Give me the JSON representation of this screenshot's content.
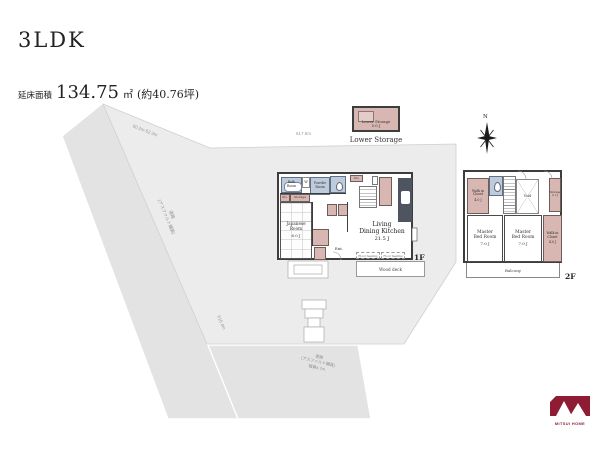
{
  "header": {
    "title": "3LDK",
    "area_label": "延床面積",
    "area_value": "134.75",
    "area_unit": "㎡",
    "area_tsubo": "(約40.76坪)"
  },
  "site": {
    "dim_top_left": "60.2m 62.3m",
    "dim_top": "617.5m",
    "dim_bottom_left": "616.4m",
    "road_left_line1": "道路",
    "road_left_line2": "(アスファルト舗装)",
    "road_bottom_line1": "道路",
    "road_bottom_line2": "(アスファルト舗装)",
    "road_bottom_line3": "幅員4.7m"
  },
  "lower_storage": {
    "label_line1": "Lower Storage",
    "label_line2": "5.0 J",
    "caption": "Lower Storage"
  },
  "compass": {
    "north_label": "N"
  },
  "floor1": {
    "floor_label": "1F",
    "bath_label": "Bath Room",
    "washer_label": "W",
    "powder_label": "Powder Room",
    "sto_top_label": "Sto.",
    "sto_left_label": "Sto.",
    "storage_label": "Storage",
    "japanese_line1": "Japanese",
    "japanese_line2": "Room",
    "japanese_size": "6.0 J",
    "entrance_label": "Ent.",
    "ldk_line1": "Living",
    "ldk_line2": "Dining Kitchen",
    "ldk_size": "21.5 J",
    "floor_heating_left": "Floor heating",
    "floor_heating_right": "Floor heating",
    "wood_deck_label": "Wood deck"
  },
  "floor2": {
    "floor_label": "2F",
    "wic_left_line1": "Walk in",
    "wic_left_line2": "Closet",
    "wic_left_size": "4.0 J",
    "void_label": "Void",
    "storage_line1": "Storage",
    "storage_size": "2.1 J",
    "master_left_line1": "Master",
    "master_left_line2": "Bed Room",
    "master_left_size": "7.0 J",
    "master_right_line1": "Master",
    "master_right_line2": "Bed Room",
    "master_right_size": "7.0 J",
    "wic_right_line1": "Walk in",
    "wic_right_line2": "Closet",
    "wic_right_size": "4.0 J",
    "balcony_label": "Balcony"
  },
  "branding": {
    "logo_text": "MITSUI HOME"
  },
  "colors": {
    "room_pink": "#d8b7b2",
    "room_blue": "#becbdd",
    "wall": "#3d3d3d",
    "logo_red": "#8e1d33",
    "site_gray": "#ececec",
    "road_gray": "#e3e3e3"
  }
}
